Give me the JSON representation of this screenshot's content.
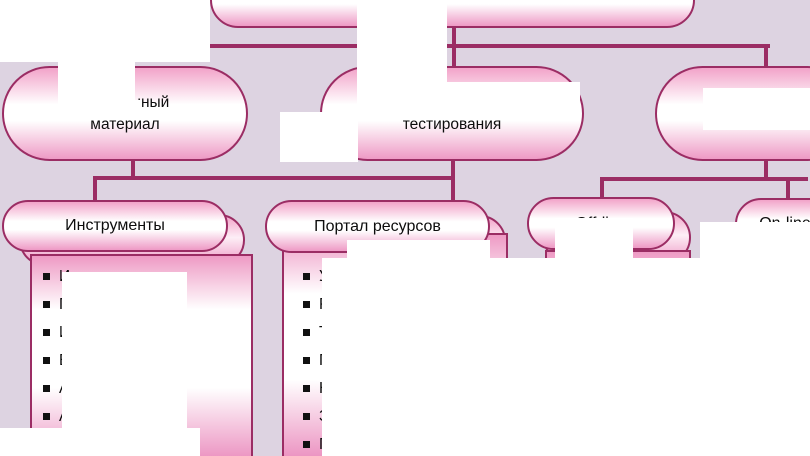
{
  "canvas": {
    "background_color": "#ddd3e1",
    "line_color": "#9b2d64",
    "node_fill_top": "#f2a3c9",
    "node_fill_bottom": "#ee9ac5",
    "occlusion_color": "#ffffff",
    "text_color": "#0d0d0d"
  },
  "diagram": {
    "top_box": {
      "label": ""
    },
    "row2": [
      {
        "line1": "Лекционный",
        "line2": "материал"
      },
      {
        "line1": "Блоки",
        "line2": "тестирования"
      },
      {
        "line1": "",
        "line2": ""
      }
    ],
    "row3": [
      {
        "label": "Инструменты"
      },
      {
        "label": "Портал ресурсов"
      },
      {
        "label": "Off-line"
      },
      {
        "label": "On-line"
      }
    ],
    "lists": {
      "instruments": [
        "Инструкция",
        "Программа",
        "Иллюстрации",
        "Видеоматериал",
        "Аудиоматериал",
        "Анимация"
      ],
      "portal": [
        "Учебники",
        "Разработки",
        "Тесты",
        "Презентации",
        "Новости",
        "Задания",
        "Программы"
      ]
    }
  },
  "occlusions": [
    [
      0,
      0,
      210,
      62
    ],
    [
      357,
      0,
      90,
      108
    ],
    [
      58,
      58,
      77,
      49
    ],
    [
      58,
      100,
      84,
      19
    ],
    [
      280,
      112,
      78,
      50
    ],
    [
      447,
      82,
      133,
      28
    ],
    [
      703,
      88,
      107,
      42
    ],
    [
      500,
      258,
      310,
      198
    ],
    [
      700,
      222,
      110,
      36
    ],
    [
      0,
      428,
      200,
      28
    ],
    [
      62,
      272,
      125,
      162
    ],
    [
      347,
      240,
      143,
      34
    ],
    [
      322,
      258,
      190,
      198
    ],
    [
      555,
      218,
      78,
      40
    ]
  ]
}
